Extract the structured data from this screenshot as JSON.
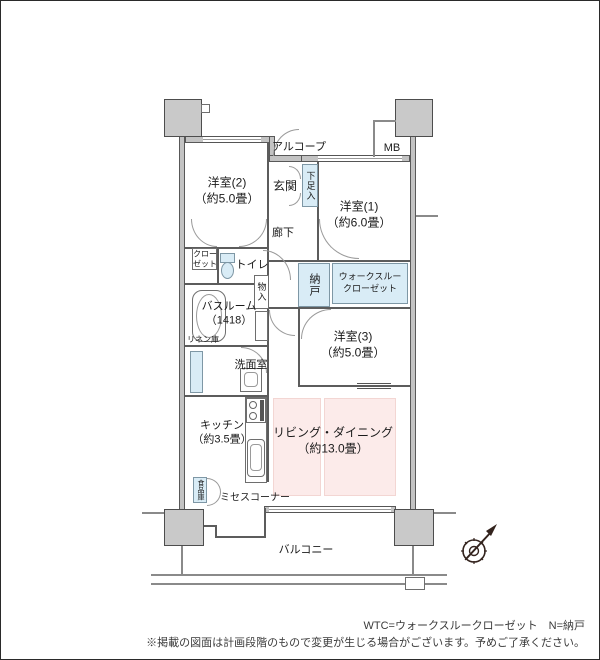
{
  "rooms": {
    "yoshitsu2": {
      "name": "洋室(2)",
      "size": "（約5.0畳）"
    },
    "alcove": {
      "name": "アルコープ"
    },
    "genkan": {
      "name": "玄関"
    },
    "shoebox": {
      "name": "下足入"
    },
    "mb": {
      "name": "MB"
    },
    "yoshitsu1": {
      "name": "洋室(1)",
      "size": "（約6.0畳）"
    },
    "corridor": {
      "name": "廊下"
    },
    "closet": {
      "line1": "クロー",
      "line2": "ゼット"
    },
    "toilet": {
      "name": "トイレ"
    },
    "nando": {
      "name": "納戸"
    },
    "wtc": {
      "line1": "ウォークスルー",
      "line2": "クローゼット"
    },
    "bathroom": {
      "name": "バスルーム",
      "size": "（1418）"
    },
    "monoire": {
      "name": "物入"
    },
    "yoshitsu3": {
      "name": "洋室(3)",
      "size": "（約5.0畳）"
    },
    "linen": {
      "name": "リネン庫"
    },
    "senmen": {
      "name": "洗面室"
    },
    "kitchen": {
      "name": "キッチン",
      "size": "（約3.5畳）"
    },
    "living": {
      "name": "リビング・ダイニング",
      "size": "（約13.0畳）"
    },
    "pantry": {
      "name": "食品庫"
    },
    "mrs_corner": {
      "name": "ミセスコーナー"
    },
    "balcony": {
      "name": "バルコニー"
    }
  },
  "footer": {
    "legend": "WTC=ウォークスルークローゼット　N=納戸",
    "note": "※掲載の図面は計画段階のもので変更が生じる場合がございます。予めご了承ください。"
  },
  "colors": {
    "storage_fill": "#d9ecf6",
    "living_fill": "#fcebea",
    "wall_fill": "#c3c3c3"
  }
}
